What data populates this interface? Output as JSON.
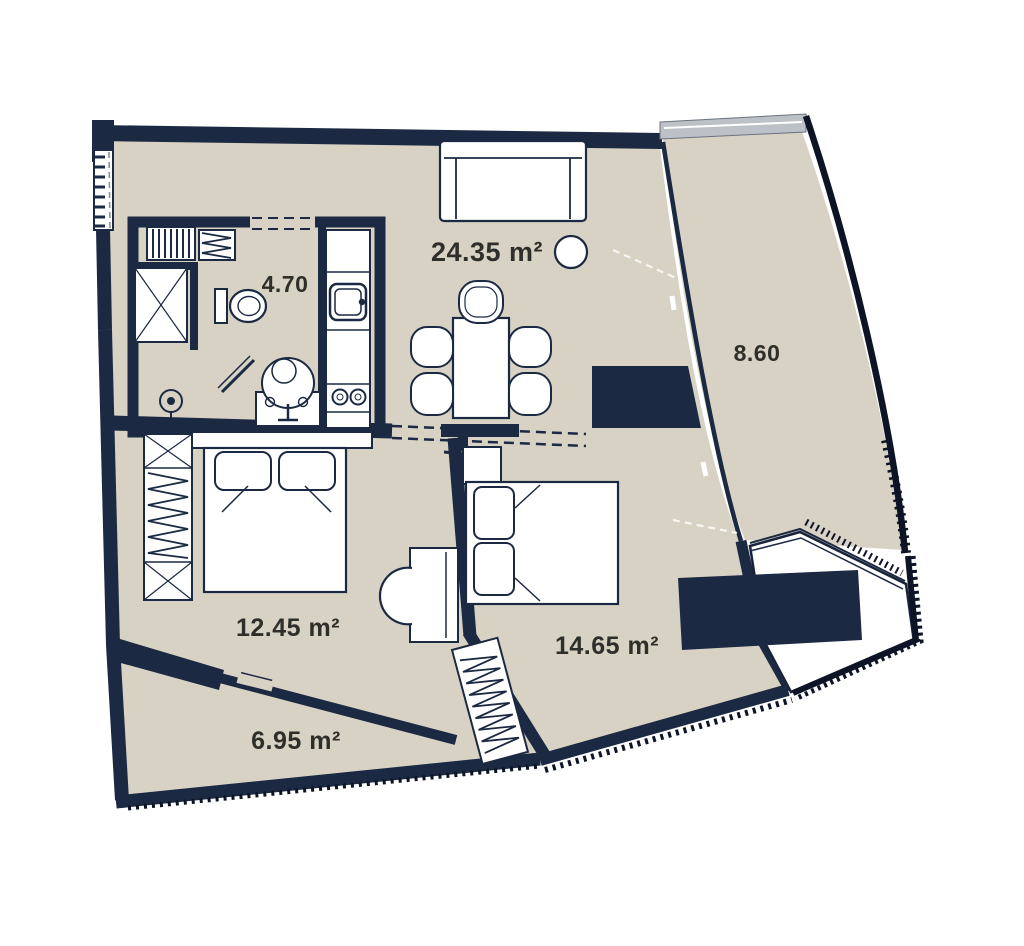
{
  "floorplan": {
    "rooms": [
      {
        "name": "living-room-kitchen",
        "label": "24.35 m²"
      },
      {
        "name": "bathroom",
        "label": "4.70"
      },
      {
        "name": "balcony",
        "label": "8.60"
      },
      {
        "name": "bedroom-1",
        "label": "12.45 m²"
      },
      {
        "name": "bedroom-2",
        "label": "14.65 m²"
      },
      {
        "name": "hallway",
        "label": "6.95 m²"
      }
    ],
    "colors": {
      "wall": "#1c2942",
      "floor": "#d7d2c4",
      "furniture_fill": "#ffffff",
      "glazing": "#bcc1c7",
      "label_text": "#2e2e2a",
      "outer_edge": "#0c1426",
      "background": "#ffffff"
    },
    "furniture_icons": [
      "sofa",
      "round-side-table",
      "dining-table",
      "dining-chair",
      "tv-stand",
      "kitchen-counter",
      "kitchen-sink",
      "hob",
      "toilet",
      "washbasin",
      "shower-door",
      "floor-drain",
      "towel-rack",
      "hanger-cabinet",
      "double-bed",
      "pillow",
      "wardrobe",
      "desk",
      "desk-chair",
      "window"
    ]
  }
}
